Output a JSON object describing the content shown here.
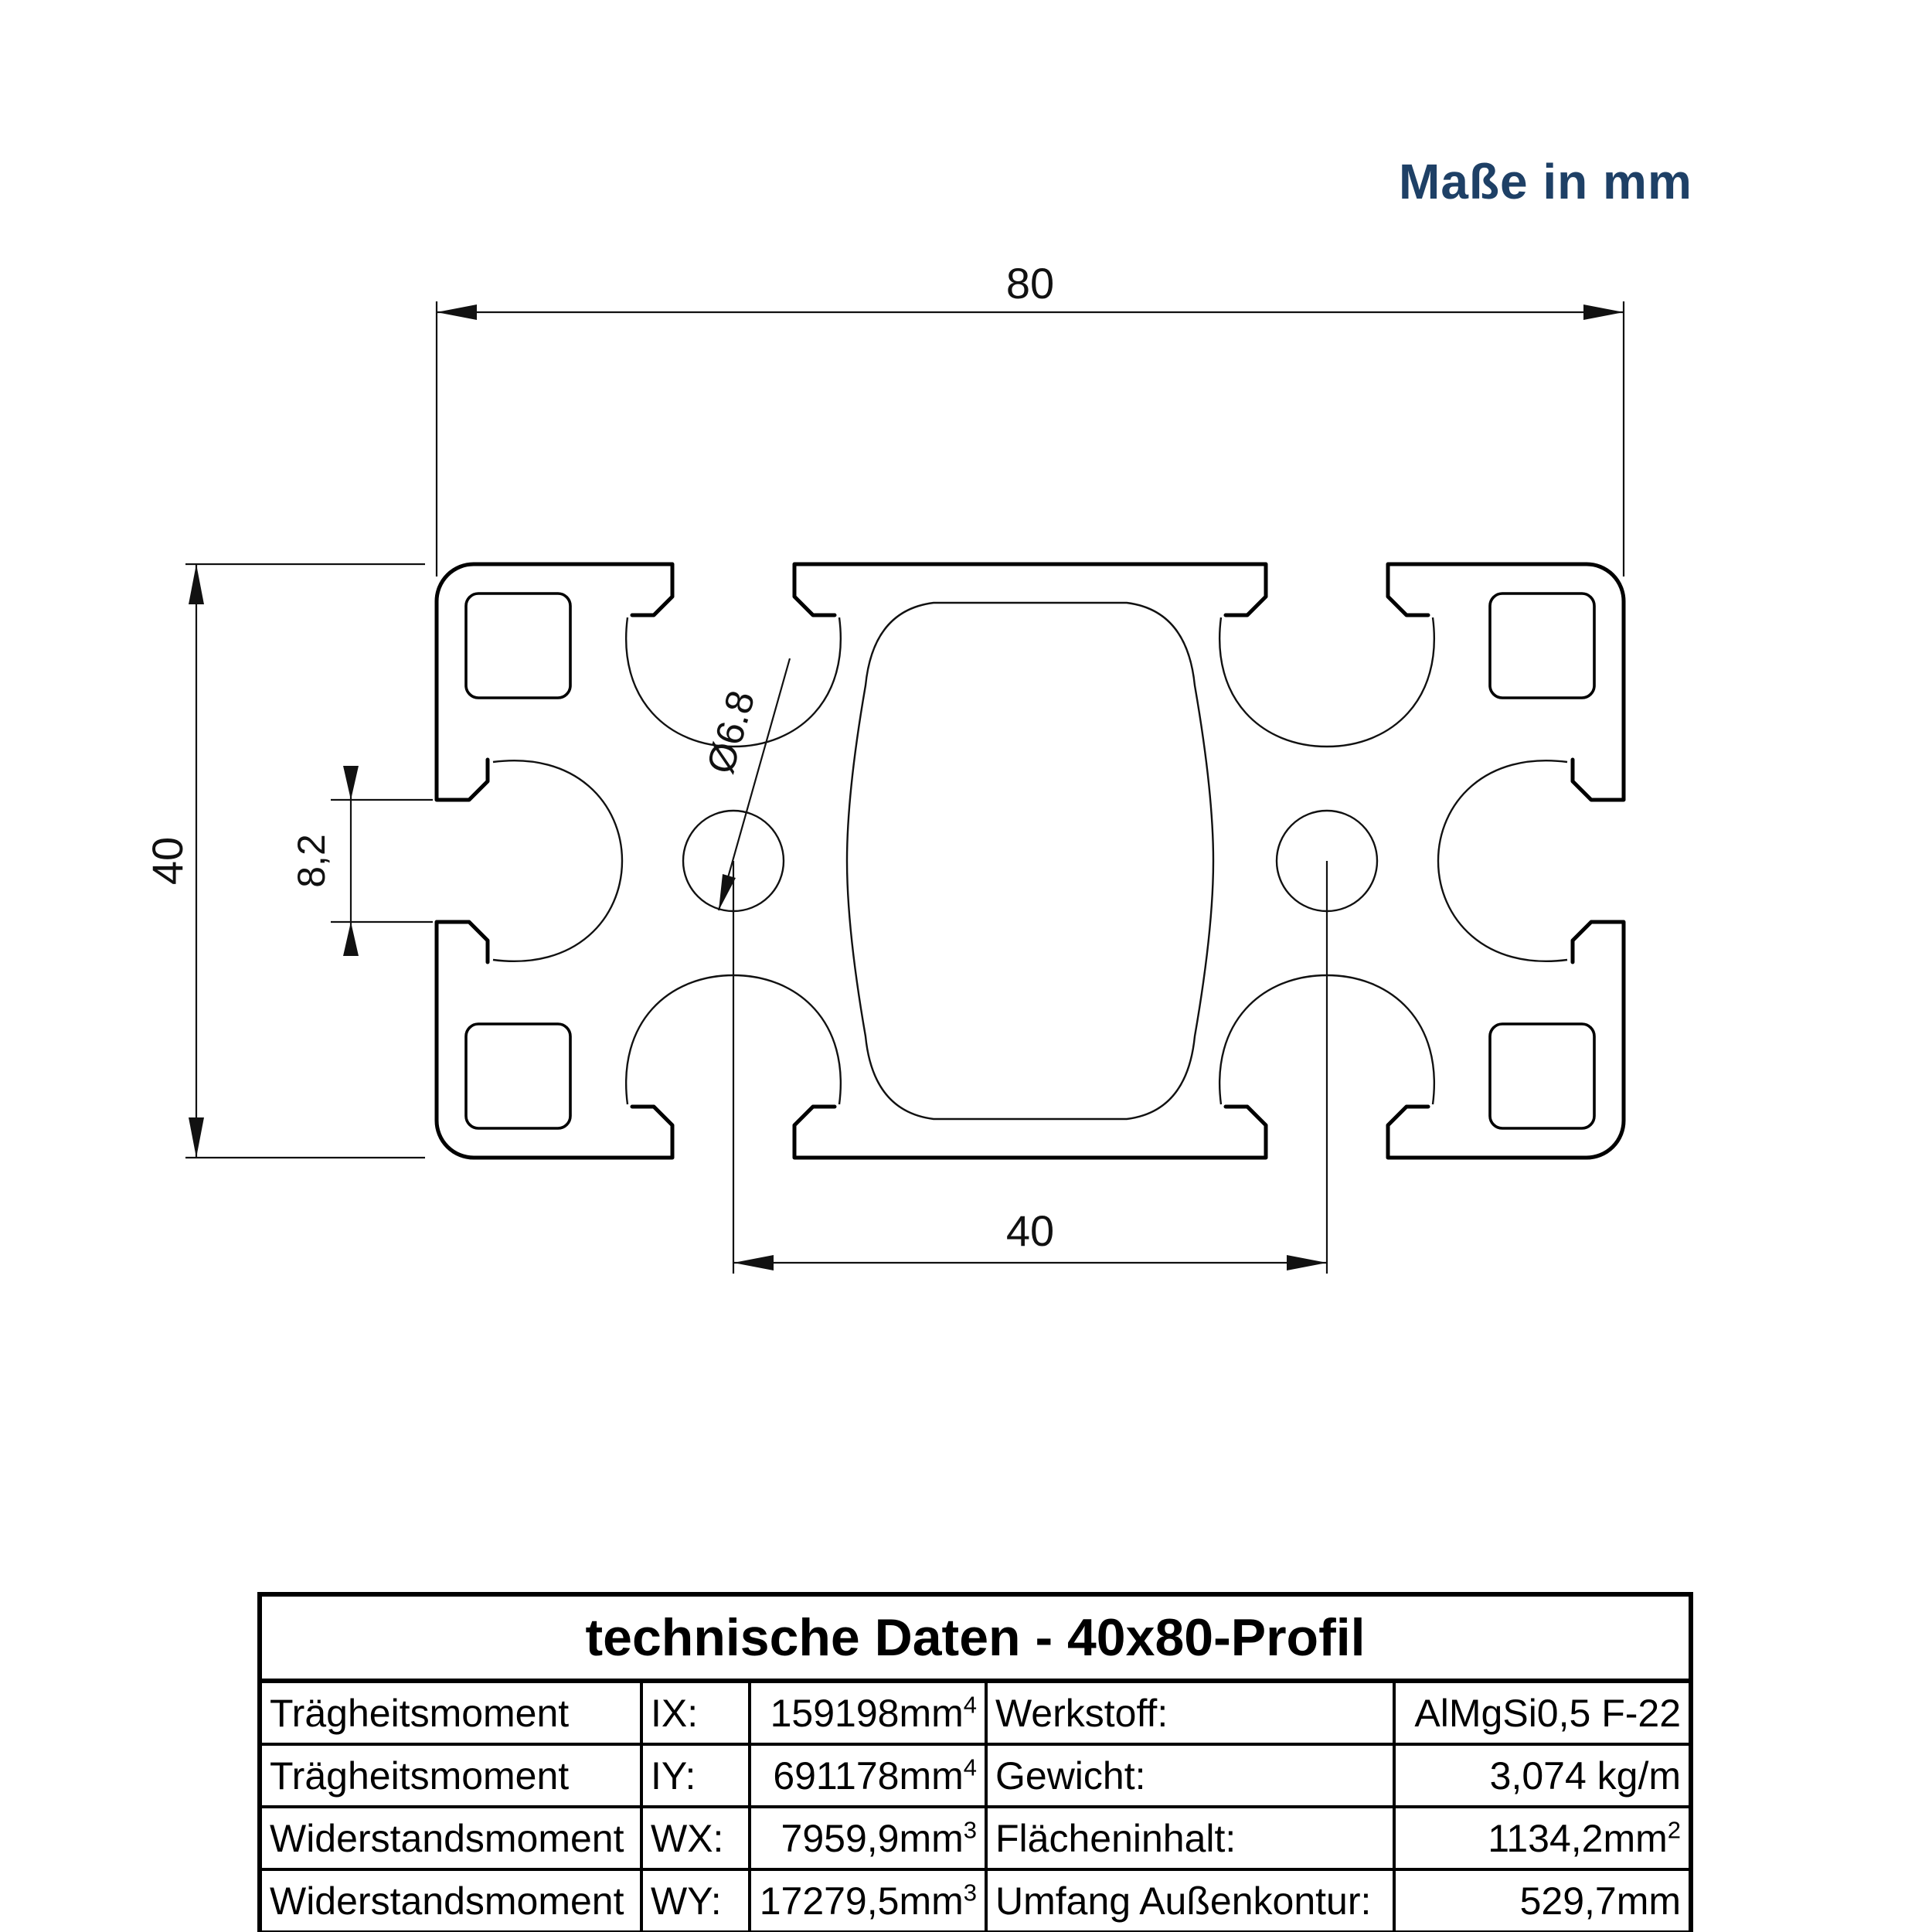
{
  "header": {
    "units_note": "Maße in mm"
  },
  "drawing": {
    "dim_width": "80",
    "dim_height": "40",
    "dim_slot_opening": "8,2",
    "dim_hole_diameter": "Ø6.8",
    "dim_hole_spacing": "40"
  },
  "table": {
    "title": "technische Daten - 40x80-Profil",
    "rows": [
      {
        "name": "Trägheitsmoment",
        "symbol": "IX:",
        "value": "159198mm",
        "value_sup": "4",
        "label2": "Werkstoff:",
        "value2": "AlMgSi0,5 F-22",
        "value2_sup": ""
      },
      {
        "name": "Trägheitsmoment",
        "symbol": "IY:",
        "value": "691178mm",
        "value_sup": "4",
        "label2": "Gewicht:",
        "value2": "3,074 kg/m",
        "value2_sup": ""
      },
      {
        "name": "Widerstandsmoment",
        "symbol": "WX:",
        "value": "7959,9mm",
        "value_sup": "3",
        "label2": "Flächeninhalt:",
        "value2": "1134,2mm",
        "value2_sup": "2"
      },
      {
        "name": "Widerstandsmoment",
        "symbol": "WY:",
        "value": "17279,5mm",
        "value_sup": "3",
        "label2": "Umfang Außenkontur:",
        "value2": "529,7mm",
        "value2_sup": ""
      }
    ]
  },
  "colors": {
    "accent_navy": "#1e4066",
    "line_black": "#000000",
    "background": "#ffffff"
  }
}
